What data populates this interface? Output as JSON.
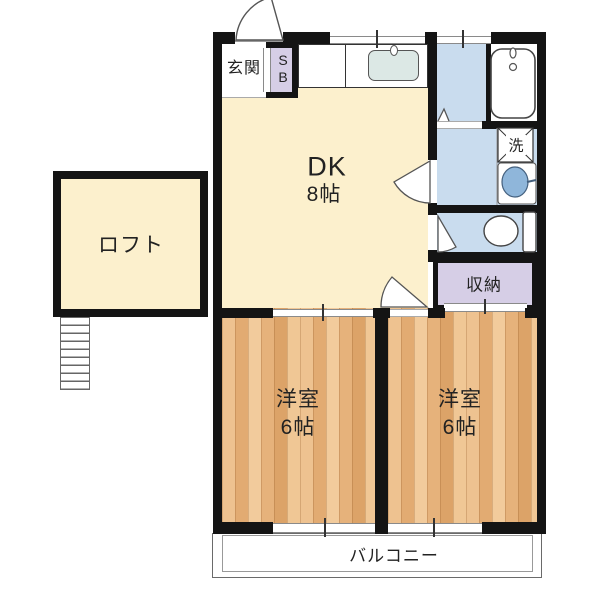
{
  "rooms": {
    "entrance": {
      "label": "玄関"
    },
    "shoe_box": {
      "line1": "S",
      "line2": "B"
    },
    "dk": {
      "name": "DK",
      "size": "8帖"
    },
    "loft": {
      "label": "ロフト"
    },
    "laundry": {
      "label": "洗"
    },
    "storage": {
      "label": "収納"
    },
    "bedroom_left": {
      "name": "洋室",
      "size": "6帖"
    },
    "bedroom_right": {
      "name": "洋室",
      "size": "6帖"
    },
    "balcony": {
      "label": "バルコニー"
    }
  },
  "colors": {
    "floor_cream": "#fcf0cd",
    "wet_area_blue": "#c9dcee",
    "closet_purple": "#d6cee6",
    "wood_light": "#f0c795",
    "wood_dark": "#dca368",
    "wall": "#141414",
    "basin_blue": "#8fb6da"
  }
}
